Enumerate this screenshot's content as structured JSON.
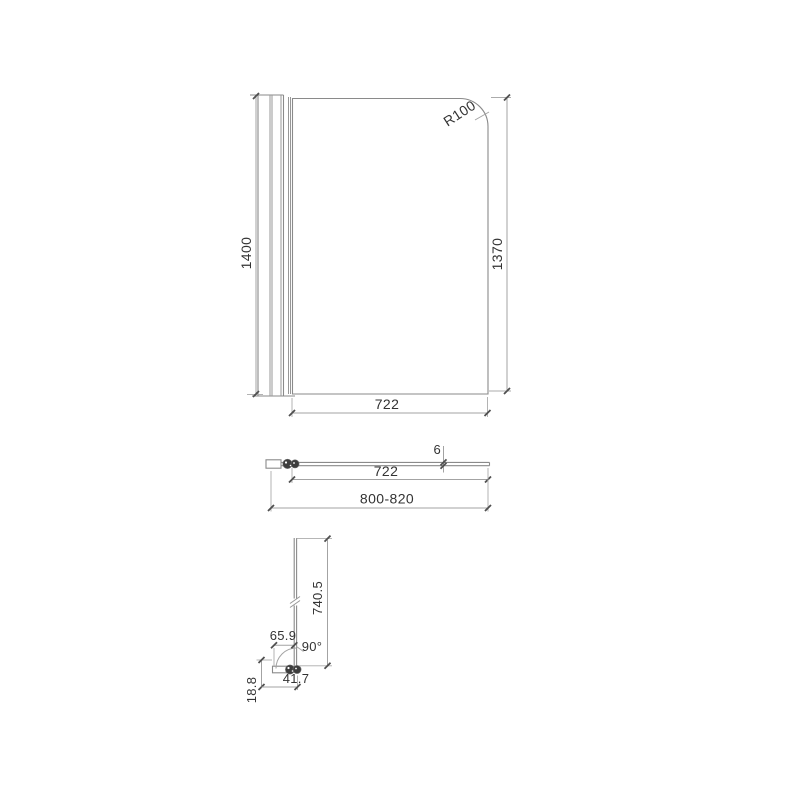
{
  "colors": {
    "object_line": "#8a8a8a",
    "dimension_line": "#a3a3a3",
    "tick": "#4f4f4f",
    "text": "#333333",
    "hinge_fill": "#3d3d3d",
    "background": "#ffffff"
  },
  "front_view": {
    "corner_radius_label": "R100",
    "overall_height": "1400",
    "glass_height": "1370",
    "glass_width": "722"
  },
  "plan_view": {
    "glass_thickness": "6",
    "glass_width": "722",
    "overall_width_range": "800-820"
  },
  "side_view": {
    "glass_height": "740.5",
    "wall_offset": "65.9",
    "angle": "90°",
    "bracket_length": "41.7",
    "bracket_height": "18.8"
  }
}
